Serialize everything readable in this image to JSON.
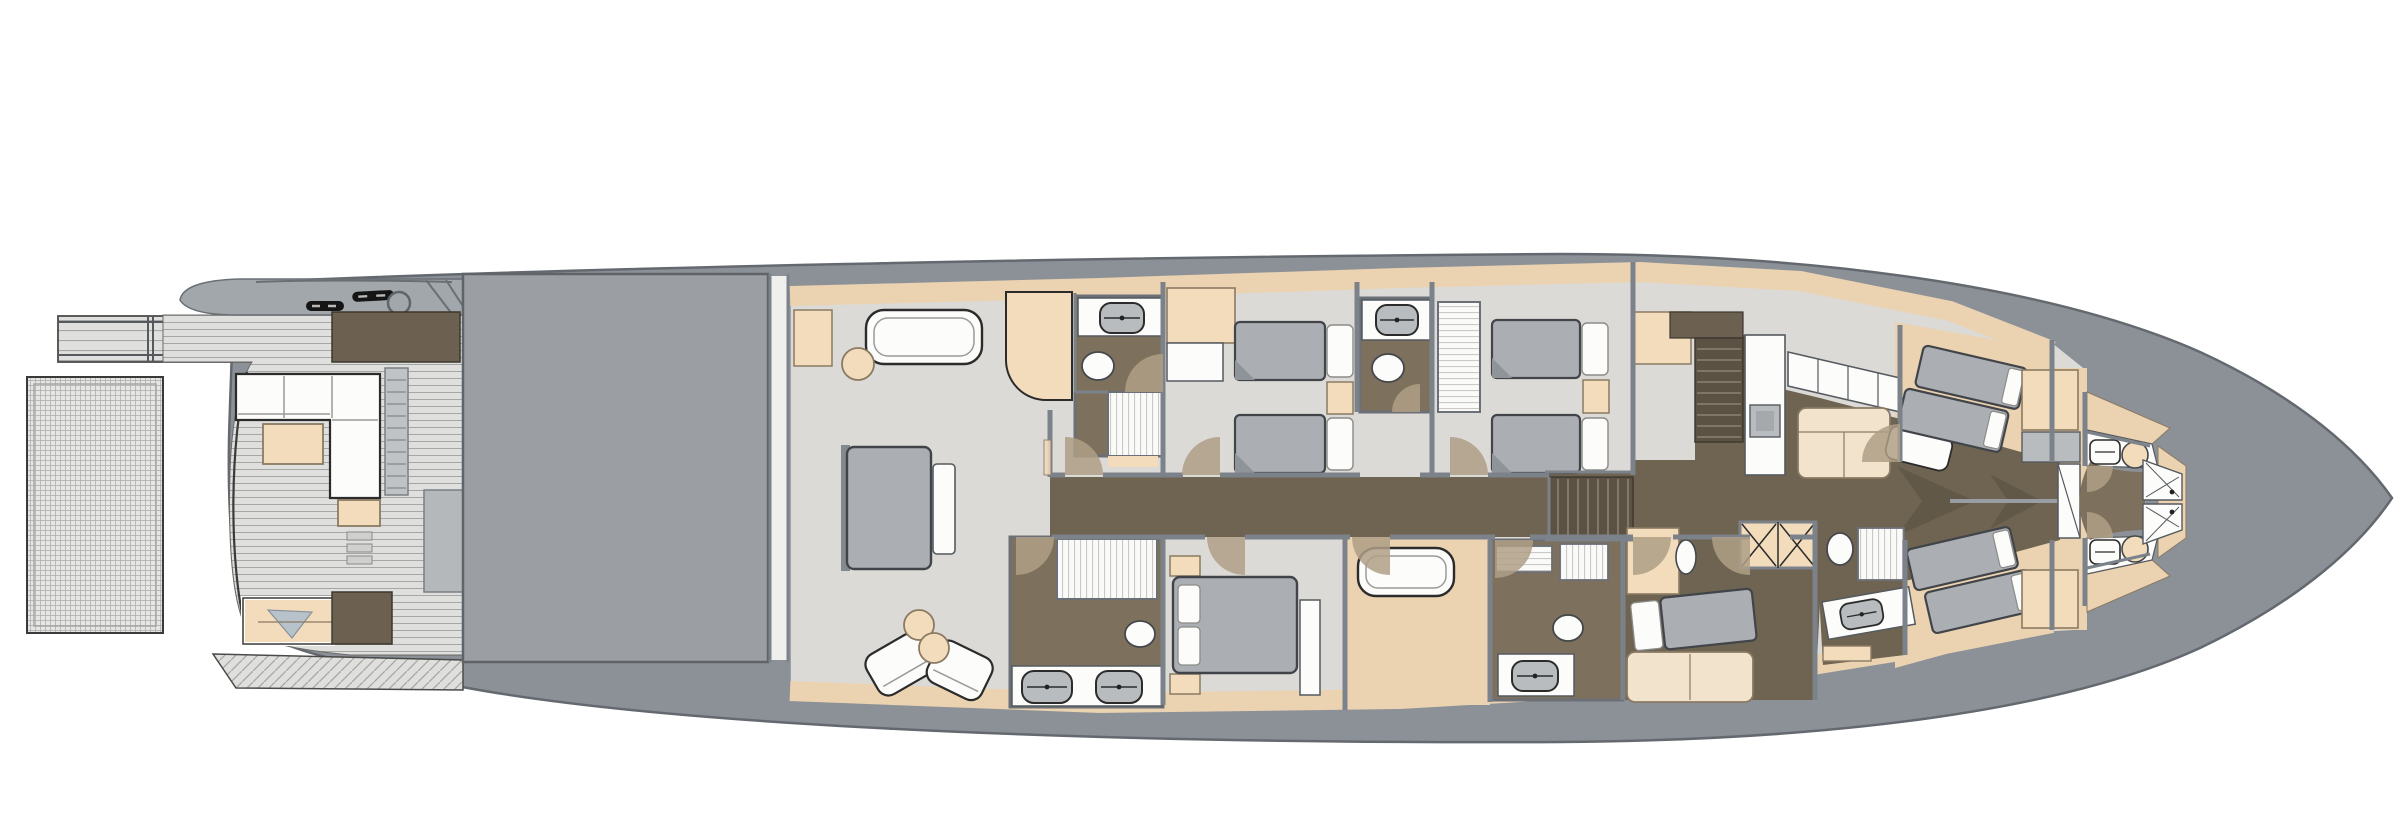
{
  "palette": {
    "background": "#FFFFFF",
    "hull_gray": "#8C9198",
    "hull_outline": "#646970",
    "superstructure_gray": "#A2A7AC",
    "deck_plank": "#DFDFDD",
    "plank_line": "#A6A6A4",
    "platform_gray": "#E6E6E4",
    "platform_dot": "#AFAFAD",
    "garage_gray": "#9B9EA3",
    "floor_light": "#DCDAD6",
    "floor_tan": "#EBD2B1",
    "tan_light": "#F2DCBC",
    "corridor_brown": "#6F6452",
    "stair_brown": "#5B5244",
    "bath_brown": "#7D705C",
    "wall_gray": "#7C828A",
    "furniture_white": "#FCFCFB",
    "furniture_cream": "#F2E4CC",
    "bed_gray": "#ABAEB2",
    "bed_outline": "#41454A",
    "cabinet_dark_brown": "#6C6051",
    "fixture_gray": "#B9BCBE",
    "stripe_gray": "#C9C9C7",
    "door_swing_tan": "#AF9F86",
    "pillow_blue_gray": "#B7C2CB",
    "black_detail": "#1A1A1A"
  },
  "plan": {
    "view": "overhead-lower-deck-floor-plan",
    "areas": [
      {
        "name": "swim-platform"
      },
      {
        "name": "passerelle"
      },
      {
        "name": "aft-deck"
      },
      {
        "name": "tender-garage"
      },
      {
        "name": "master-cabin"
      },
      {
        "name": "master-bathroom-forward"
      },
      {
        "name": "master-bathroom-aft"
      },
      {
        "name": "guest-twin-cabin-port"
      },
      {
        "name": "guest-twin-cabin-starboard"
      },
      {
        "name": "guest-bathroom"
      },
      {
        "name": "vip-cabin"
      },
      {
        "name": "vip-lounge"
      },
      {
        "name": "vip-bathroom"
      },
      {
        "name": "main-corridor"
      },
      {
        "name": "corridor-stairs"
      },
      {
        "name": "galley"
      },
      {
        "name": "crew-mess"
      },
      {
        "name": "crew-stairs"
      },
      {
        "name": "crew-cabin-aft"
      },
      {
        "name": "crew-cabin-mid"
      },
      {
        "name": "crew-cabin-forward"
      },
      {
        "name": "laundry-hatch"
      },
      {
        "name": "bow-crew-cabin"
      },
      {
        "name": "bow-bathroom-port"
      },
      {
        "name": "bow-bathroom-starboard"
      }
    ],
    "fixtures": {
      "double_beds": 2,
      "single_beds": 4,
      "bunk_bed_groups": 3,
      "v_berth": 1,
      "sofas": 4,
      "armchairs": 2,
      "coffee_tables": 1,
      "round_side_tables": 3,
      "toilets": 7,
      "sinks": 8,
      "showers": 4,
      "wardrobes": 5,
      "sun_pads": 1,
      "staircases": 3,
      "door_swings": 14,
      "deck_cleats": 2,
      "deck_hatches": 1,
      "laundry_hatches": 1
    }
  }
}
